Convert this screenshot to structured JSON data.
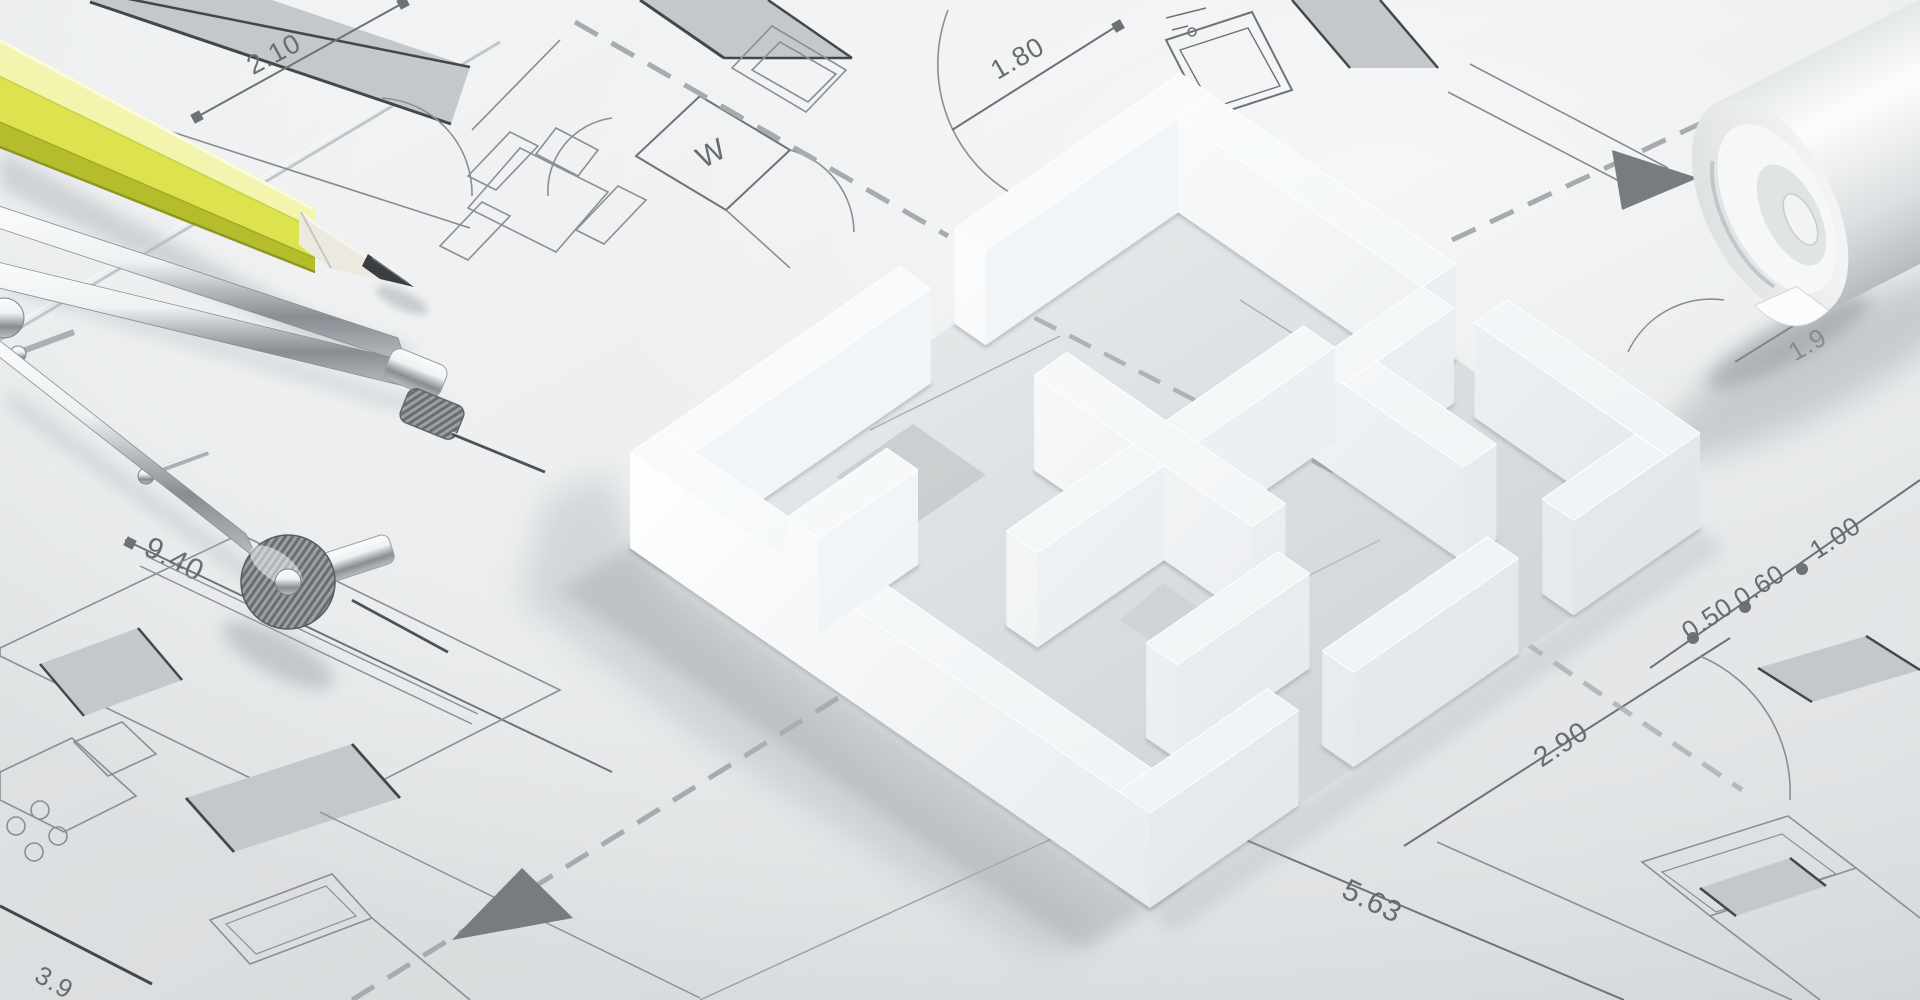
{
  "scene": {
    "type": "3d-architectural-render",
    "description": "White 3D house floor-plan model standing on architectural blueprint sheets, with a yellow drafting pencil, a chrome drafting compass and a rolled-up plan sheet",
    "palette": {
      "paper": "#eef0f1",
      "paper_dark": "#d9dcde",
      "line_thin": "#878b8f",
      "line_heavy": "#43474a",
      "wall_fill": "#c4c8ca",
      "dash": "#a6abae",
      "dim_text": "#686c70",
      "model_top": "#fbfdfe",
      "model_lit": "#ffffff",
      "model_shade": "#d8dee2",
      "shadow": "#b2b8bc",
      "pencil_yellow": "#dde24f",
      "pencil_dark": "#b6bd2c",
      "wood": "#ece9e0",
      "graphite": "#3b3e41",
      "chrome_light": "#f4f6f7",
      "chrome_dark": "#6f757a"
    },
    "labels": {
      "dim_top_left": "2.10",
      "dim_top_right": "1.80",
      "dim_left": "9.40",
      "dim_bottom": "5.63",
      "dim_right_lower": "2.90",
      "dim_right_1": "0.50",
      "dim_right_2": "0.60",
      "dim_right_3": "1.00",
      "dim_bottom_left_partial": "3.9",
      "dim_right_edge_partial": "1.9",
      "room_symbol": "W"
    },
    "model": {
      "projection": {
        "x0": 1180,
        "y0": 168,
        "ux": 52,
        "uy": 36,
        "vx": -55,
        "vy": 38,
        "wall_height": 95
      },
      "walls": [
        [
          0,
          0,
          0.6,
          4.1
        ],
        [
          0,
          5.1,
          0.6,
          10
        ],
        [
          0.6,
          0,
          5.3,
          0.6
        ],
        [
          6.3,
          0,
          10,
          0.6
        ],
        [
          9.4,
          0.6,
          10,
          2.3
        ],
        [
          9.4,
          3.3,
          10,
          6.3
        ],
        [
          9.4,
          7.3,
          10,
          10
        ],
        [
          0,
          9.4,
          10,
          10
        ],
        [
          2.8,
          4.7,
          7.0,
          5.3
        ],
        [
          4.7,
          2.2,
          5.3,
          4.7
        ],
        [
          4.7,
          5.3,
          5.3,
          7.6
        ],
        [
          5.3,
          0.6,
          5.9,
          2.6
        ],
        [
          5.9,
          2.0,
          8.2,
          2.6
        ],
        [
          7.6,
          5.4,
          8.2,
          7.8
        ],
        [
          2.4,
          7.6,
          3.0,
          9.4
        ]
      ]
    },
    "objects": [
      {
        "name": "floorplan-model",
        "label": "white 3D floor plan model"
      },
      {
        "name": "pencil",
        "label": "yellow drafting pencil"
      },
      {
        "name": "drafting-compass",
        "label": "chrome drafting compass"
      },
      {
        "name": "paper-roll",
        "label": "rolled blueprint sheet"
      },
      {
        "name": "blueprint",
        "label": "architectural blueprint drawing"
      }
    ]
  }
}
